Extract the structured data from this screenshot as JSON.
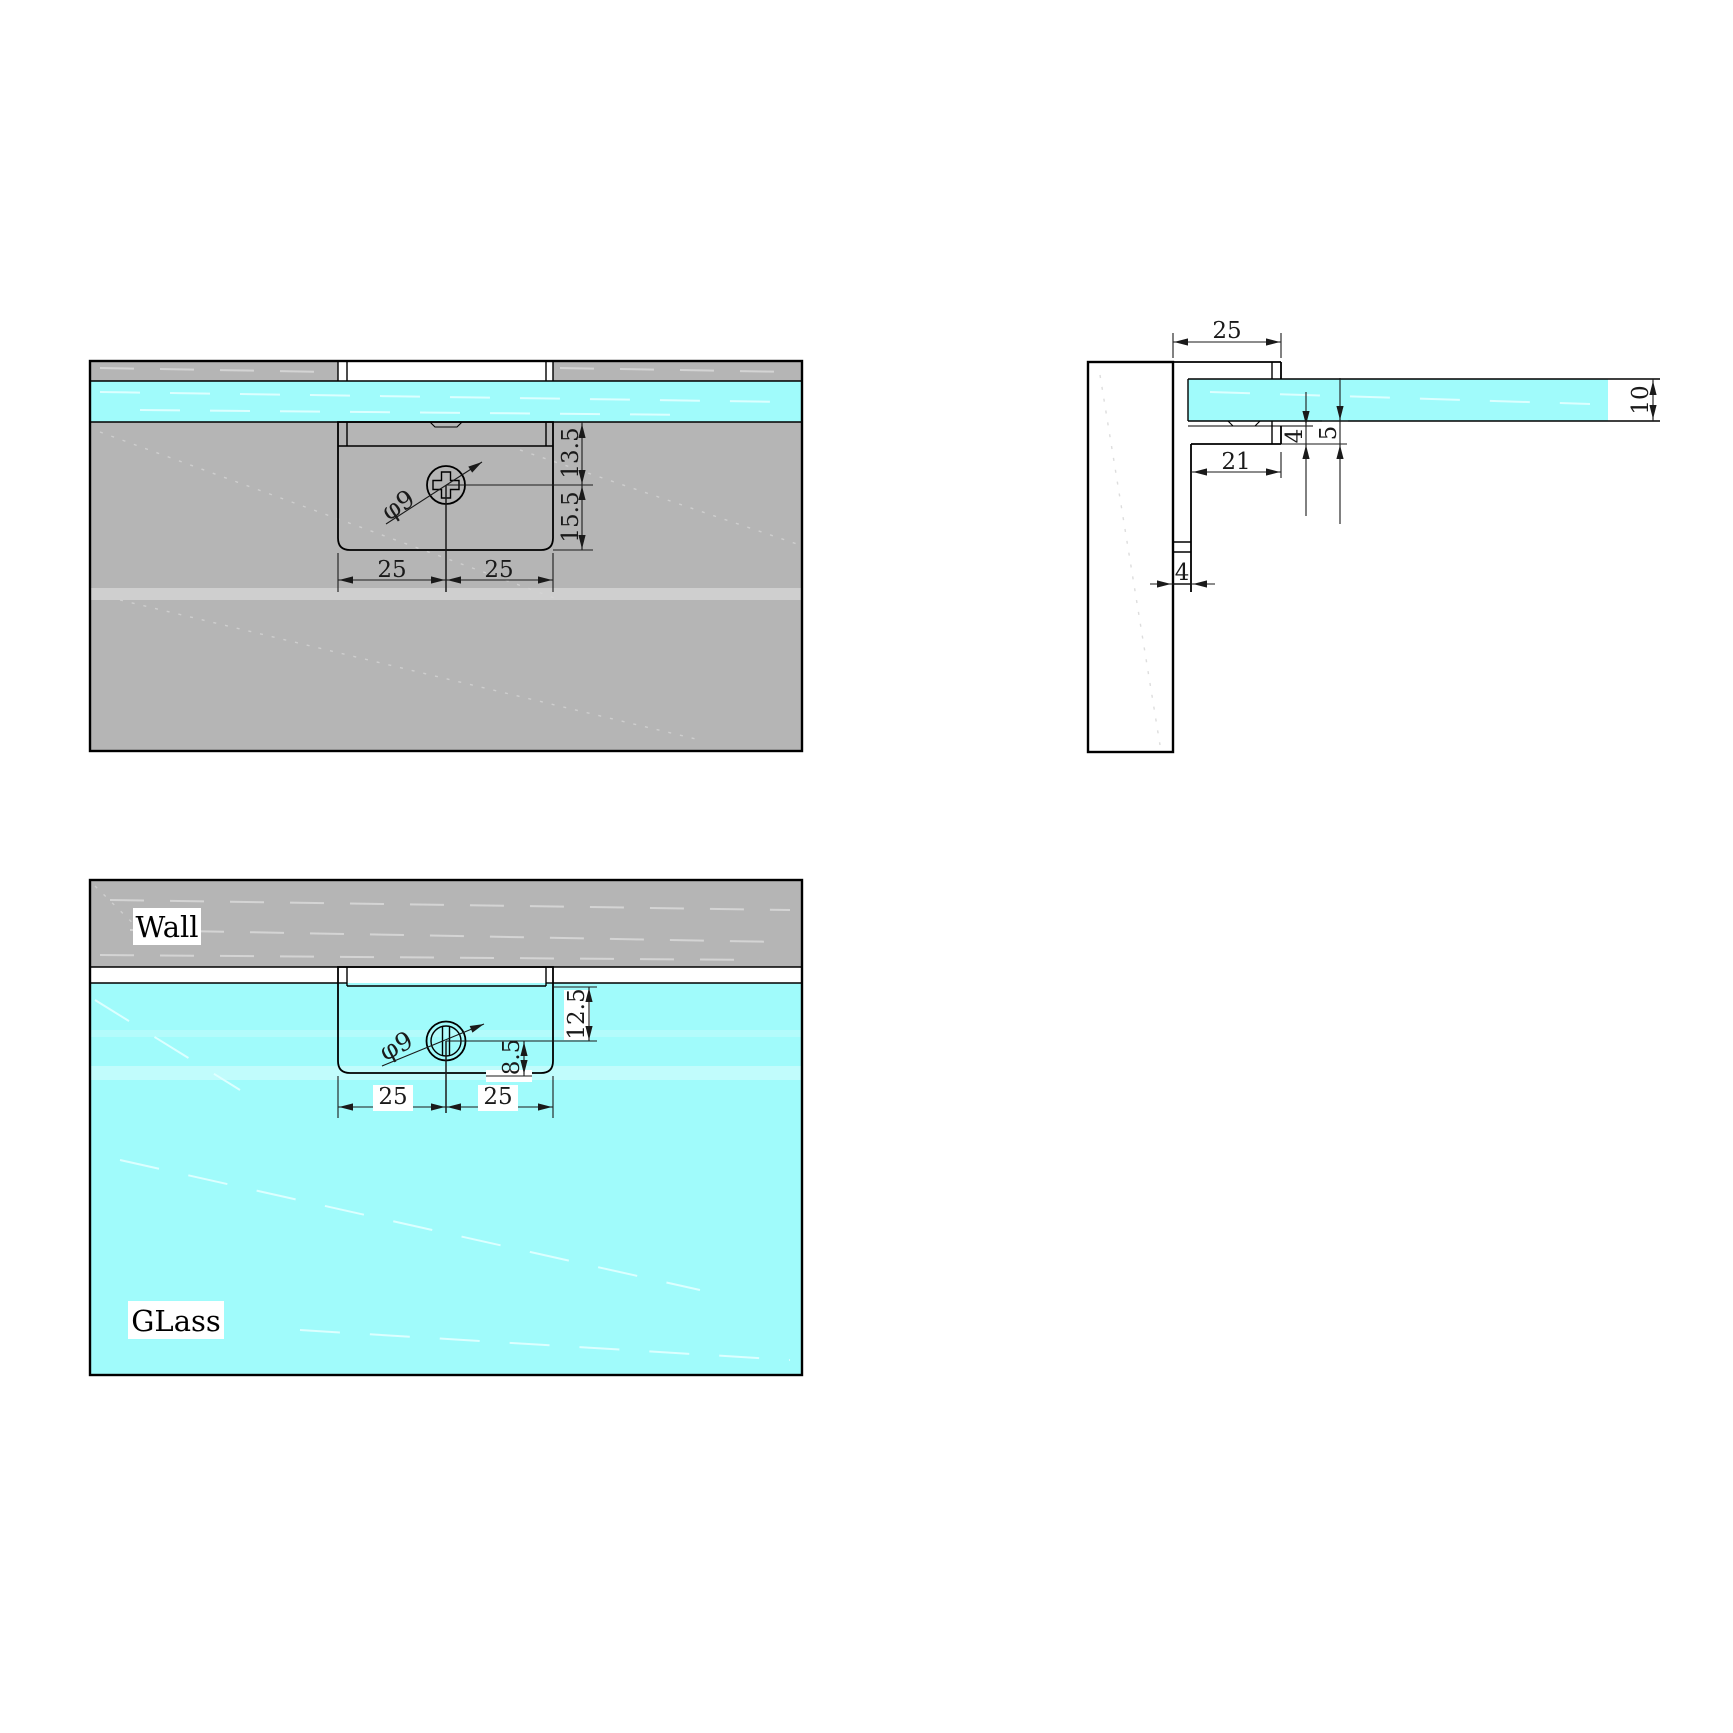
{
  "colors": {
    "wall_gray": "#b5b5b5",
    "glass_cyan": "#a0fbfb",
    "line_black": "#000000",
    "dim_gray": "#1a1a1a",
    "texture_light": "#d4d4d4"
  },
  "views": {
    "wall_side_front": {
      "dims": {
        "hole_diameter": "φ9",
        "glass_edge_to_center": "13.5",
        "center_to_bottom": "15.5",
        "left_half_width": "25",
        "right_half_width": "25"
      }
    },
    "side_section": {
      "dims": {
        "arm_length": "25",
        "glass_thickness": "10",
        "arm_plate_thickness": "4",
        "glass_seat_depth": "5",
        "inner_arm_length": "21",
        "wall_plate_thickness": "4"
      }
    },
    "glass_side_front": {
      "labels": {
        "wall": "Wall",
        "glass": "GLass"
      },
      "dims": {
        "hole_diameter": "φ9",
        "glass_top_to_center": "12.5",
        "center_to_bottom": "8.5",
        "left_half_width": "25",
        "right_half_width": "25"
      }
    }
  }
}
